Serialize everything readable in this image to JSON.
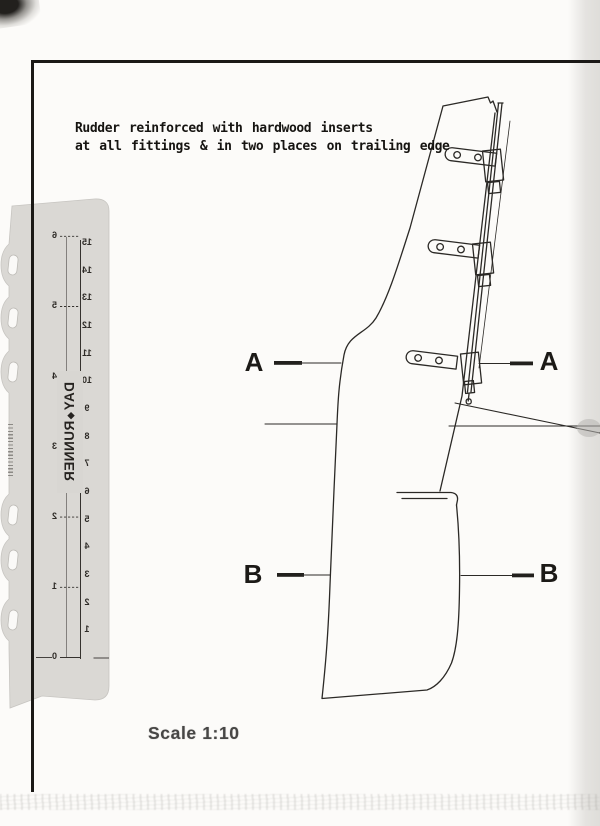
{
  "document": {
    "annotation": {
      "line1": "Rudder reinforced with hardwood inserts",
      "line2": "at all fittings & in two places on trailing edge"
    },
    "scale_label": "Scale 1:10",
    "section_markers": {
      "a_left": "A",
      "a_right": "A",
      "b_left": "B",
      "b_right": "B"
    }
  },
  "ruler": {
    "brand_first": "DAY",
    "brand_second": "RUNNER",
    "inch_labels": [
      "6",
      "5",
      "4",
      "3",
      "2",
      "1",
      "0"
    ],
    "cm_labels": [
      "15",
      "14",
      "13",
      "12",
      "11",
      "10",
      "9",
      "8",
      "7",
      "6",
      "5",
      "4",
      "3",
      "2",
      "1"
    ],
    "body_color": "#d8d6d2",
    "marking_color": "#35322e"
  },
  "colors": {
    "paper": "#fcfbf9",
    "ink": "#2b2926",
    "border": "#1b1916",
    "scale_text": "#474645"
  }
}
